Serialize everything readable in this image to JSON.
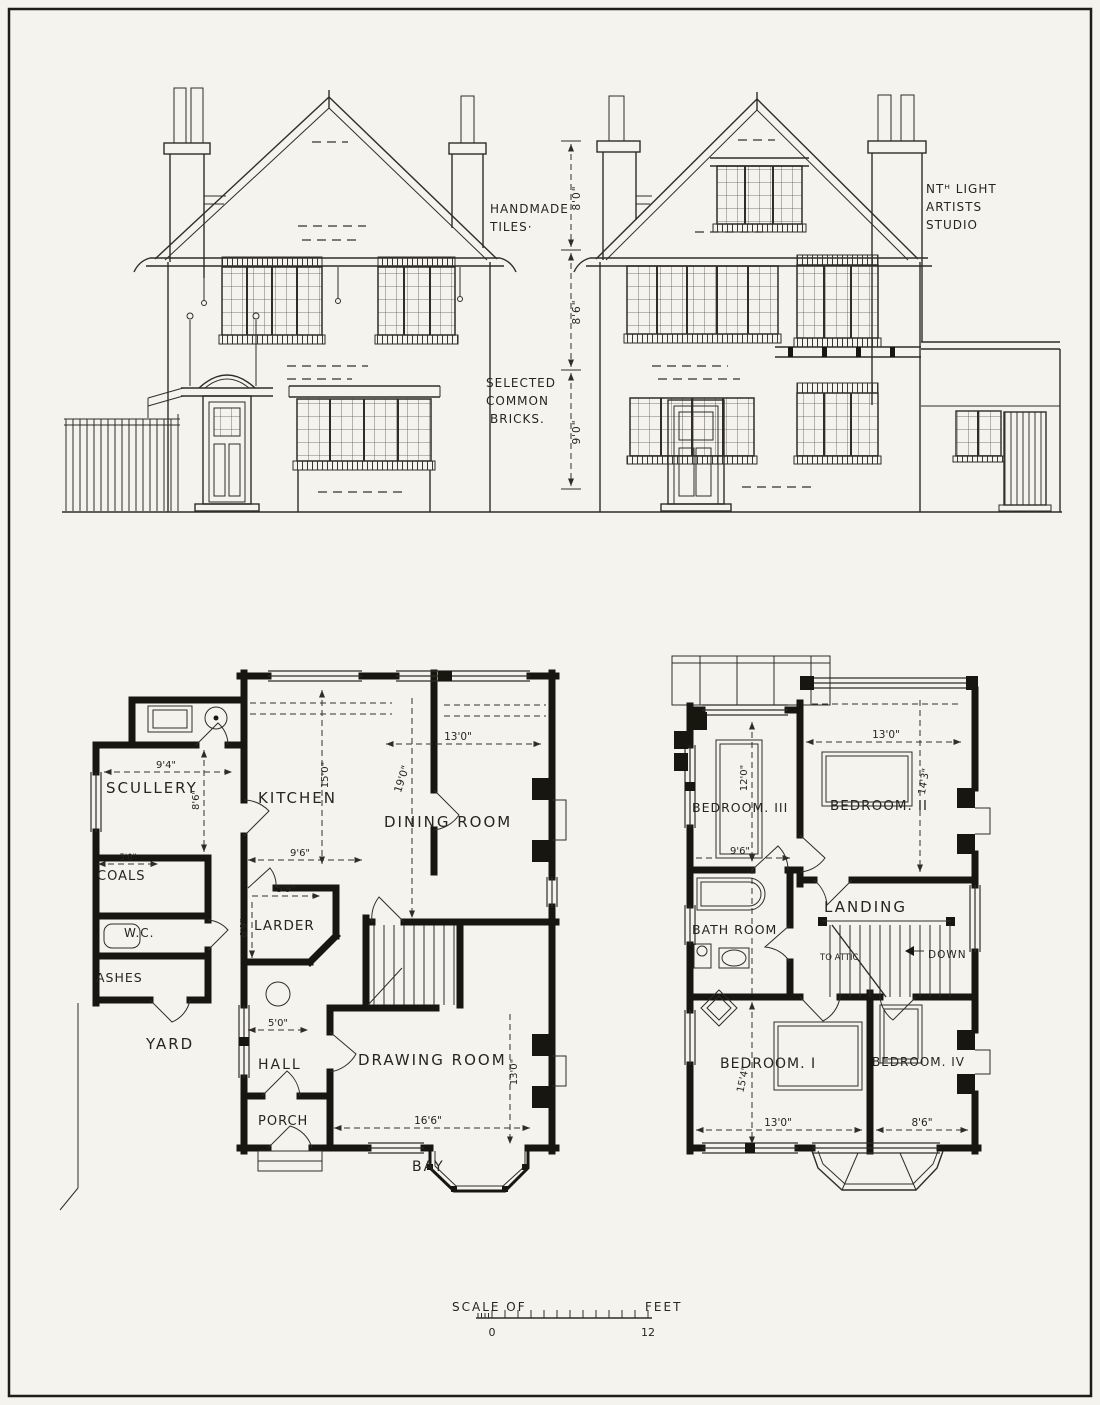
{
  "elevations": {
    "notes": {
      "tiles": [
        "HANDMADE",
        "TILES·"
      ],
      "bricks": [
        "SELECTED",
        "COMMON",
        "BRICKS."
      ],
      "studio": [
        "NTᴴ LIGHT",
        "ARTISTS",
        "STUDIO"
      ]
    },
    "storey_heights": [
      "8'0\"",
      "8'6\"",
      "9'0\""
    ]
  },
  "ground_floor": {
    "scullery": {
      "label": "SCULLERY",
      "width": "9'4\"",
      "depth": "8'6\""
    },
    "kitchen": {
      "label": "KITCHEN",
      "length": "15'0\"",
      "width": "9'6\""
    },
    "dining": {
      "label": "DINING ROOM",
      "width": "13'0\"",
      "length": "19'0\""
    },
    "coals": {
      "label": "COALS",
      "width": "5'0\""
    },
    "larder": {
      "label": "LARDER",
      "width": "5'9\"",
      "depth": "6'9\""
    },
    "wc": {
      "label": "W.C."
    },
    "ashes": {
      "label": "ASHES"
    },
    "yard": {
      "label": "YARD"
    },
    "hall": {
      "label": "HALL",
      "width": "5'0\""
    },
    "porch": {
      "label": "PORCH"
    },
    "drawing_room": {
      "label": "DRAWING ROOM",
      "width": "16'6\"",
      "depth": "13'0\""
    },
    "bay": {
      "label": "BAY"
    }
  },
  "first_floor": {
    "bedroom3": {
      "label": "BEDROOM. III",
      "depth": "12'0\"",
      "width": "9'6\""
    },
    "bedroom2": {
      "label": "BEDROOM. II",
      "width": "13'0\"",
      "depth": "14'3\""
    },
    "bathroom": {
      "label": "BATH ROOM"
    },
    "landing": {
      "label": "LANDING"
    },
    "stairs": {
      "to_attic": "TO ATTIC",
      "down": "DOWN"
    },
    "bedroom1": {
      "label": "BEDROOM. I",
      "depth": "15'4\"",
      "width": "13'0\""
    },
    "bedroom4": {
      "label": "BEDROOM. IV",
      "width": "8'6\""
    }
  },
  "scale_bar": {
    "prefix": "SCALE OF",
    "suffix": "FEET",
    "start": "0",
    "end": "12"
  }
}
